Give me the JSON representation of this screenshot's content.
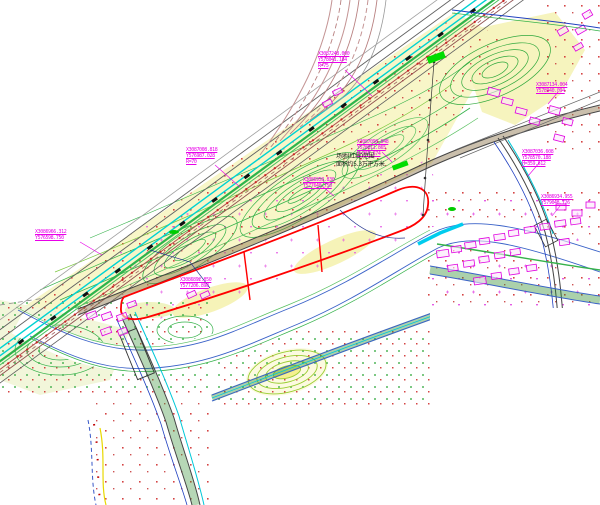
{
  "canvas": {
    "width": 600,
    "height": 505
  },
  "palette": {
    "annotation_magenta": "#E800E8",
    "boundary_red": "#FF0000",
    "contour_green": "#35B24A",
    "water_blue": "#3A62C8",
    "utility_cyan": "#00D2D2",
    "railway_brown": "#C49494",
    "terrain_yellow": "#F8F6C8",
    "highlight_green": "#00DD00"
  },
  "labels": [
    {
      "lines": [
        "X3087248.000",
        "Y578041.184",
        "R=75"
      ]
    },
    {
      "lines": [
        "X3087008.818",
        "Y576987.028",
        "R=70"
      ]
    },
    {
      "lines": [
        "X3086966.312",
        "Y576598.750"
      ]
    },
    {
      "lines": [
        "X3087098.848",
        "Y578011.865",
        "H=365.674"
      ]
    },
    {
      "lines": [
        "X3087036.608",
        "Y578570.188",
        "H=359.612"
      ]
    },
    {
      "lines": [
        "X3086934.955",
        "Y579048.726"
      ]
    },
    {
      "lines": [
        "X3086892.850",
        "Y577206.898"
      ]
    },
    {
      "lines": [
        "X3086958.830",
        "Y577640.750"
      ]
    },
    {
      "lines": [
        "X3087134.004",
        "Y578940.094"
      ]
    }
  ],
  "site_note": {
    "lines": [
      "场地(红线)范围",
      "面积约5.3万平方米"
    ]
  }
}
